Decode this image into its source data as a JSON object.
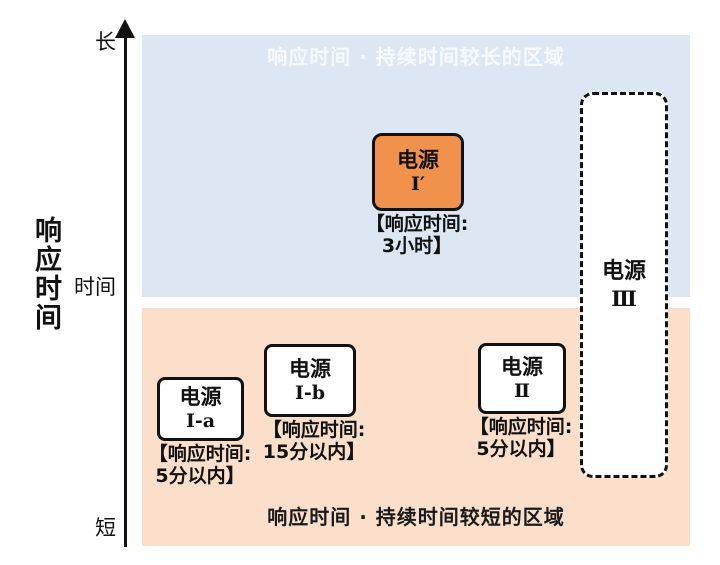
{
  "axis": {
    "title": "响应时间",
    "ticks": {
      "top": "长",
      "middle": "时间",
      "bottom": "短"
    }
  },
  "regions": {
    "long": {
      "label": "响应时间 · 持续时间较长的区域"
    },
    "short": {
      "label": "响应时间 · 持续时间较短的区域"
    }
  },
  "nodes": {
    "source_i_prime": {
      "name_line1": "电源",
      "name_line2": "Ⅰ′",
      "caption_line1": "【响应时间:",
      "caption_line2": "3小时】"
    },
    "source_iii": {
      "name_line1": "电源",
      "name_line2": "Ⅲ"
    },
    "source_i_a": {
      "name_line1": "电源",
      "name_line2": "Ⅰ-a",
      "caption_line1": "【响应时间:",
      "caption_line2": "5分以内】"
    },
    "source_i_b": {
      "name_line1": "电源",
      "name_line2": "Ⅰ-b",
      "caption_line1": "【响应时间:",
      "caption_line2": "15分以内】"
    },
    "source_ii": {
      "name_line1": "电源",
      "name_line2": "Ⅱ",
      "caption_line1": "【响应时间:",
      "caption_line2": "5分以内】"
    }
  },
  "colors": {
    "region_long_bg": "#dce7f3",
    "region_short_bg": "#fbdfca",
    "node_highlight_bg": "#f0924c",
    "node_bg": "#ffffff",
    "border_and_text": "#111111",
    "region_long_label_text": "#f7f9fc",
    "region_short_label_text": "#1a1a1a"
  }
}
